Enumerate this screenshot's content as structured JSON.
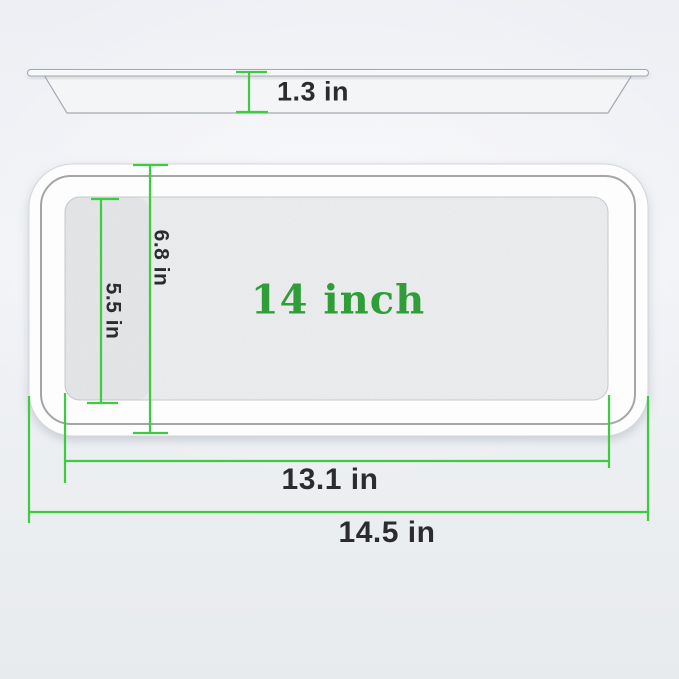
{
  "diagram": {
    "side_view": {
      "height_label": "1.3 in"
    },
    "top_view": {
      "size_label": "14 inch",
      "inner_depth_label": "6.8 in",
      "floor_depth_label": "5.5 in",
      "floor_width_label": "13.1 in",
      "overall_width_label": "14.5 in"
    }
  },
  "colors": {
    "dimension_line": "#3dcc3d",
    "size_text": "#2f9e38",
    "label_text": "#2c2c2e",
    "background": "#eef0f4",
    "tray_fill": "#fdfdfe",
    "rim_line": "#85878a"
  }
}
